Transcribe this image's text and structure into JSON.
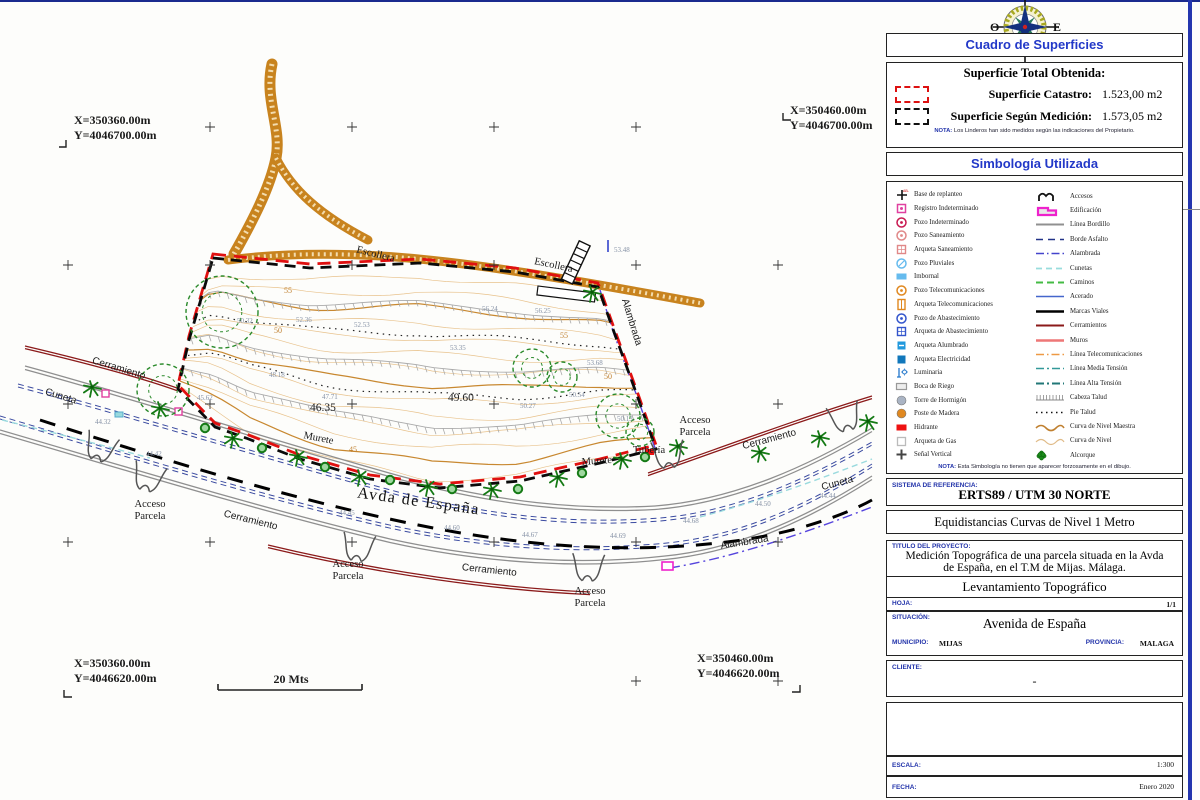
{
  "compass": {
    "west": "O",
    "east": "E",
    "south": "S",
    "southwest": "SO",
    "southeast": "SE"
  },
  "panel": {
    "surfaces": {
      "header": "Cuadro de Superficies",
      "total_label": "Superficie Total Obtenida:",
      "rows": [
        {
          "label": "Superficie Catastro:",
          "value": "1.523,00 m2"
        },
        {
          "label": "Superficie Según Medición:",
          "value": "1.573,05 m2"
        }
      ],
      "note_label": "NOTA:",
      "note": "Los Linderos han sido medidos según las indicaciones del Propietario."
    },
    "symbology": {
      "header": "Simbología Utilizada",
      "note_label": "NOTA:",
      "note": "Esta Simbología no tienen que aparecer forzosamente en el dibujo.",
      "left": [
        {
          "label": "Base de replanteo",
          "icon": "base-replanteo-icon",
          "kind": "base",
          "color": "#111111",
          "tag": "AB-101"
        },
        {
          "label": "Registro Indeterminado",
          "icon": "registro-indeterminado-icon",
          "kind": "square-dot",
          "color": "#e040a0"
        },
        {
          "label": "Pozo Indeterminado",
          "icon": "pozo-indeterminado-icon",
          "kind": "circle-dot",
          "color": "#c81850"
        },
        {
          "label": "Pozo Saneamiento",
          "icon": "pozo-saneamiento-icon",
          "kind": "circle-dot",
          "color": "#e08888"
        },
        {
          "label": "Arqueta Saneamiento",
          "icon": "arqueta-saneamiento-icon",
          "kind": "square-grid",
          "color": "#e08888"
        },
        {
          "label": "Pozo Pluviales",
          "icon": "pozo-pluviales-icon",
          "kind": "circle-slash",
          "color": "#66bbee"
        },
        {
          "label": "Imbornal",
          "icon": "imbornal-icon",
          "kind": "rect-fill",
          "color": "#66bbee"
        },
        {
          "label": "Pozo Telecomunicaciones",
          "icon": "pozo-telecomunicaciones-icon",
          "kind": "circle-dot",
          "color": "#e08820"
        },
        {
          "label": "Arqueta Telecomunicaciones",
          "icon": "arqueta-telecomunicaciones-icon",
          "kind": "rect-split",
          "color": "#e08820"
        },
        {
          "label": "Pozo de Abastecimiento",
          "icon": "pozo-abastecimiento-icon",
          "kind": "circle-dot",
          "color": "#3355cc"
        },
        {
          "label": "Arqueta de Abastecimiento",
          "icon": "arqueta-abastecimiento-icon",
          "kind": "square-grid",
          "color": "#3355cc"
        },
        {
          "label": "Arqueta Alumbrado",
          "icon": "arqueta-alumbrado-icon",
          "kind": "square-dash",
          "color": "#2299dd"
        },
        {
          "label": "Arqueta Electricidad",
          "icon": "arqueta-electricidad-icon",
          "kind": "square-fill",
          "color": "#1177bb"
        },
        {
          "label": "Luminaria",
          "icon": "luminaria-icon",
          "kind": "lamp",
          "color": "#2277cc"
        },
        {
          "label": "Boca de Riego",
          "icon": "boca-riego-icon",
          "kind": "rect",
          "color": "#999999"
        },
        {
          "label": "Torre de Hormigón",
          "icon": "torre-hormigon-icon",
          "kind": "circle-fill",
          "color": "#aab4c4"
        },
        {
          "label": "Poste de Madera",
          "icon": "poste-madera-icon",
          "kind": "circle-fill",
          "color": "#e08820"
        },
        {
          "label": "Hidrante",
          "icon": "hidrante-icon",
          "kind": "rect-solid",
          "color": "#ee1111"
        },
        {
          "label": "Arqueta de Gas",
          "icon": "arqueta-gas-icon",
          "kind": "square",
          "color": "#bbbbbb"
        },
        {
          "label": "Señal Vertical",
          "icon": "senal-vertical-icon",
          "kind": "plus",
          "color": "#444444"
        }
      ],
      "right": [
        {
          "label": "Accesos",
          "icon": "accesos-icon",
          "kind": "arches",
          "color": "#111111"
        },
        {
          "label": "Edificación",
          "icon": "edificacion-icon",
          "kind": "building",
          "color": "#ee22cc"
        },
        {
          "label": "Línea Bordillo",
          "icon": "linea-bordillo-icon",
          "kind": "line",
          "color": "#909090",
          "dash": "",
          "w": 2
        },
        {
          "label": "Borde Asfalto",
          "icon": "borde-asfalto-icon",
          "kind": "line",
          "color": "#223388",
          "dash": "7,5",
          "w": 1.6
        },
        {
          "label": "Alambrada",
          "icon": "alambrada-icon",
          "kind": "line",
          "color": "#4444cc",
          "dash": "8,3,1.5,3",
          "w": 1.6
        },
        {
          "label": "Cunetas",
          "icon": "cunetas-icon",
          "kind": "line",
          "color": "#99dddd",
          "dash": "6,4",
          "w": 1.8
        },
        {
          "label": "Caminos",
          "icon": "caminos-icon",
          "kind": "line",
          "color": "#44bb44",
          "dash": "7,4",
          "w": 2
        },
        {
          "label": "Acerado",
          "icon": "acerado-icon",
          "kind": "line",
          "color": "#4466cc",
          "dash": "",
          "w": 1.6
        },
        {
          "label": "Marcas Viales",
          "icon": "marcas-viales-icon",
          "kind": "line",
          "color": "#000000",
          "dash": "",
          "w": 2.6
        },
        {
          "label": "Cerramientos",
          "icon": "cerramientos-icon",
          "kind": "line",
          "color": "#8b1a1a",
          "dash": "",
          "w": 2
        },
        {
          "label": "Muros",
          "icon": "muros-icon",
          "kind": "line",
          "color": "#ee7777",
          "dash": "",
          "w": 2.6
        },
        {
          "label": "Línea Telecomunicaciones",
          "icon": "linea-telecomunicaciones-icon",
          "kind": "line",
          "color": "#ee9944",
          "dash": "8,3,1.5,3",
          "w": 1.6
        },
        {
          "label": "Línea Media Tensión",
          "icon": "linea-media-tension-icon",
          "kind": "line",
          "color": "#339999",
          "dash": "8,3,2,3",
          "w": 1.6
        },
        {
          "label": "Línea Alta Tensión",
          "icon": "linea-alta-tension-icon",
          "kind": "line",
          "color": "#227777",
          "dash": "8,3,2,3",
          "w": 2
        },
        {
          "label": "Cabeza Talud",
          "icon": "cabeza-talud-icon",
          "kind": "hatch",
          "color": "#888888"
        },
        {
          "label": "Pie Talud",
          "icon": "pie-talud-icon",
          "kind": "line",
          "color": "#111111",
          "dash": "1.5,3.5",
          "w": 1.6
        },
        {
          "label": "Curva de Nivel Maestra",
          "icon": "curva-nivel-maestra-icon",
          "kind": "wave",
          "color": "#c08030",
          "w": 1.6
        },
        {
          "label": "Curva de Nivel",
          "icon": "curva-nivel-icon",
          "kind": "wave",
          "color": "#e0bb88",
          "w": 1.2
        },
        {
          "label": "Alcorque",
          "icon": "alcorque-icon",
          "kind": "tree",
          "color": "#1a8a1a"
        }
      ]
    },
    "reference": {
      "label": "SISTEMA DE REFERENCIA:",
      "value": "ERTS89 / UTM 30 NORTE"
    },
    "equidistance": "Equidistancias Curvas de Nivel 1 Metro",
    "project": {
      "label": "TITULO DEL PROYECTO:",
      "title_line1": "Medición Topográfica  de una parcela situada en la Avda",
      "title_line2": "de España,  en el T.M de Mijas. Málaga.",
      "subtitle": "Levantamiento Topográfico",
      "sheet_label": "HOJA:",
      "sheet_value": "1/1",
      "situation_label": "SITUACIÓN:",
      "situation_value": "Avenida de España",
      "municipality_label": "MUNICIPIO:",
      "municipality_value": "MIJAS",
      "province_label": "PROVINCIA:",
      "province_value": "MALAGA"
    },
    "client": {
      "label": "CLIENTE:",
      "value": "-"
    },
    "scale": {
      "label": "ESCALA:",
      "value": "1:300"
    },
    "date": {
      "label": "FECHA:",
      "value": "Enero 2020"
    }
  },
  "map": {
    "corners": [
      {
        "id": "top-left",
        "x": "X=350360.00m",
        "y": "Y=4046700.00m"
      },
      {
        "id": "top-right",
        "x": "X=350460.00m",
        "y": "Y=4046700.00m"
      },
      {
        "id": "bottom-left",
        "x": "X=350360.00m",
        "y": "Y=4046620.00m"
      },
      {
        "id": "bottom-right",
        "x": "X=350460.00m",
        "y": "Y=4046620.00m"
      }
    ],
    "scale_bar": "20 Mts",
    "feature_labels": [
      {
        "t": "Escollera",
        "x": 375,
        "y": 257,
        "r": 14,
        "c": "lab-serif"
      },
      {
        "t": "Escollera",
        "x": 553,
        "y": 268,
        "r": 12,
        "c": "lab-serif"
      },
      {
        "t": "Alambrada",
        "x": 629,
        "y": 323,
        "r": 73,
        "c": "lab-sans"
      },
      {
        "t": "Cerramiento",
        "x": 118,
        "y": 371,
        "r": 17,
        "c": "lab-sans"
      },
      {
        "t": "Cuneta",
        "x": 60,
        "y": 399,
        "r": 17,
        "c": "lab-sans"
      },
      {
        "t": "Murete",
        "x": 318,
        "y": 441,
        "r": 11,
        "c": "lab-serif"
      },
      {
        "t": "Murete",
        "x": 597,
        "y": 464,
        "r": -4,
        "c": "lab-serif"
      },
      {
        "t": "Tubería",
        "x": 649,
        "y": 453,
        "r": 0,
        "c": "lab-serif"
      },
      {
        "t": "Avda de España",
        "x": 418,
        "y": 506,
        "r": 8,
        "c": "lab-avenue"
      },
      {
        "t": "Cerramiento",
        "x": 250,
        "y": 523,
        "r": 14,
        "c": "lab-sans"
      },
      {
        "t": "Cerramiento",
        "x": 489,
        "y": 573,
        "r": 6,
        "c": "lab-sans"
      },
      {
        "t": "Cerramiento",
        "x": 770,
        "y": 442,
        "r": -15,
        "c": "lab-sans"
      },
      {
        "t": "Cuneta",
        "x": 838,
        "y": 486,
        "r": -15,
        "c": "lab-sans"
      },
      {
        "t": "Alambrada",
        "x": 745,
        "y": 545,
        "r": -9,
        "c": "lab-sans"
      },
      {
        "t": "Acceso",
        "x": 150,
        "y": 507,
        "r": 0,
        "c": "lab-serif"
      },
      {
        "t": "Parcela",
        "x": 150,
        "y": 519,
        "r": 0,
        "c": "lab-serif"
      },
      {
        "t": "Acceso",
        "x": 348,
        "y": 567,
        "r": 0,
        "c": "lab-serif"
      },
      {
        "t": "Parcela",
        "x": 348,
        "y": 579,
        "r": 0,
        "c": "lab-serif"
      },
      {
        "t": "Acceso",
        "x": 590,
        "y": 594,
        "r": 0,
        "c": "lab-serif"
      },
      {
        "t": "Parcela",
        "x": 590,
        "y": 606,
        "r": 0,
        "c": "lab-serif"
      },
      {
        "t": "Acceso",
        "x": 695,
        "y": 423,
        "r": 0,
        "c": "lab-serif"
      },
      {
        "t": "Parcela",
        "x": 695,
        "y": 435,
        "r": 0,
        "c": "lab-serif"
      }
    ],
    "spot_labels": [
      {
        "t": "46.35",
        "x": 310,
        "y": 411
      },
      {
        "t": "49.60",
        "x": 448,
        "y": 401
      }
    ],
    "elevation_labels": [
      {
        "t": "50.32",
        "x": 237,
        "y": 323
      },
      {
        "t": "52.36",
        "x": 296,
        "y": 322
      },
      {
        "t": "52.53",
        "x": 354,
        "y": 327
      },
      {
        "t": "48.18",
        "x": 269,
        "y": 377
      },
      {
        "t": "45.62",
        "x": 197,
        "y": 400
      },
      {
        "t": "47.71",
        "x": 322,
        "y": 399
      },
      {
        "t": "56.24",
        "x": 482,
        "y": 311
      },
      {
        "t": "56.25",
        "x": 535,
        "y": 313
      },
      {
        "t": "53.35",
        "x": 450,
        "y": 350
      },
      {
        "t": "53.68",
        "x": 587,
        "y": 365
      },
      {
        "t": "50.27",
        "x": 520,
        "y": 408
      },
      {
        "t": "50.54",
        "x": 569,
        "y": 397
      },
      {
        "t": "53.48",
        "x": 614,
        "y": 252
      },
      {
        "t": "50.13",
        "x": 617,
        "y": 421
      },
      {
        "t": "44.32",
        "x": 95,
        "y": 424
      },
      {
        "t": "44.42",
        "x": 146,
        "y": 456
      },
      {
        "t": "44.45",
        "x": 339,
        "y": 515
      },
      {
        "t": "44.60",
        "x": 444,
        "y": 530
      },
      {
        "t": "44.67",
        "x": 522,
        "y": 537
      },
      {
        "t": "44.69",
        "x": 610,
        "y": 538
      },
      {
        "t": "44.68",
        "x": 683,
        "y": 523
      },
      {
        "t": "44.50",
        "x": 755,
        "y": 506
      },
      {
        "t": "44.44",
        "x": 820,
        "y": 498
      }
    ],
    "contour_labels": [
      {
        "t": "55",
        "x": 288,
        "y": 293
      },
      {
        "t": "55",
        "x": 564,
        "y": 338
      },
      {
        "t": "50",
        "x": 278,
        "y": 333
      },
      {
        "t": "50",
        "x": 608,
        "y": 379
      },
      {
        "t": "45",
        "x": 353,
        "y": 452
      }
    ]
  }
}
